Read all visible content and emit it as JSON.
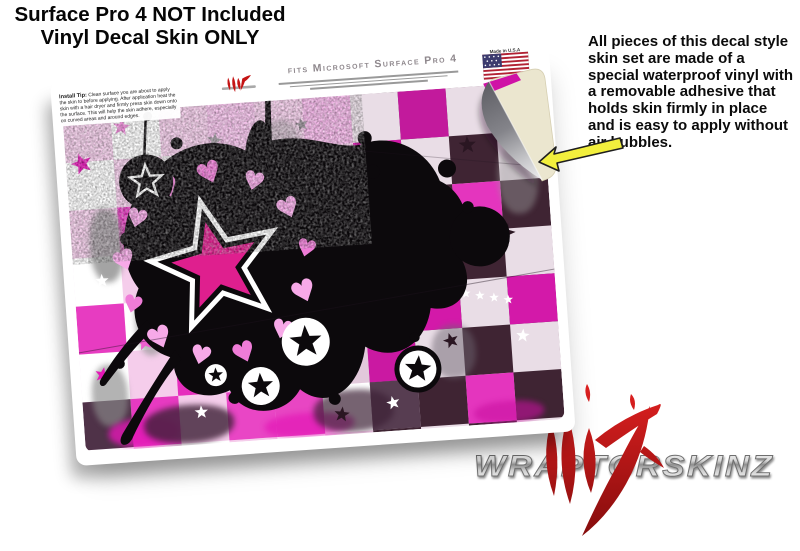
{
  "title": {
    "line1": "Surface Pro 4 NOT Included",
    "line2": "Vinyl Decal Skin ONLY"
  },
  "description": "All pieces of this decal style skin set are made of a special waterproof vinyl with a removable adhesive that holds skin firmly in place and is easy to apply without air bubbles.",
  "skin": {
    "fits": "fits Microsoft Surface Pro 4",
    "made_in": "Made in U.S.A",
    "tip_title": "Install Tip:",
    "tip_body": "Clean surface you are about to apply the skin to before applying. After application heat the skin with a hair dryer and firmly press skin down onto the surface. This will help the skin adhere, especially on curved areas and around edges."
  },
  "brand": {
    "name": "WRAPTORSKINZ"
  },
  "colors": {
    "hot_magenta": "#e318b6",
    "mid_pink": "#ee86da",
    "pale_pink": "#f5cdeb",
    "dark_plum": "#3d2136",
    "star_pink": "#df1f8e",
    "splat_black": "#0c090c",
    "heart_pink": "#f7a9e8",
    "heart_pink2": "#ef7cd7",
    "arrow_yellow": "#f2ef3d",
    "claw_red": "#c41414",
    "backing_cream": "#ebe6cf",
    "chrome_silver": "#d8d8d8"
  }
}
